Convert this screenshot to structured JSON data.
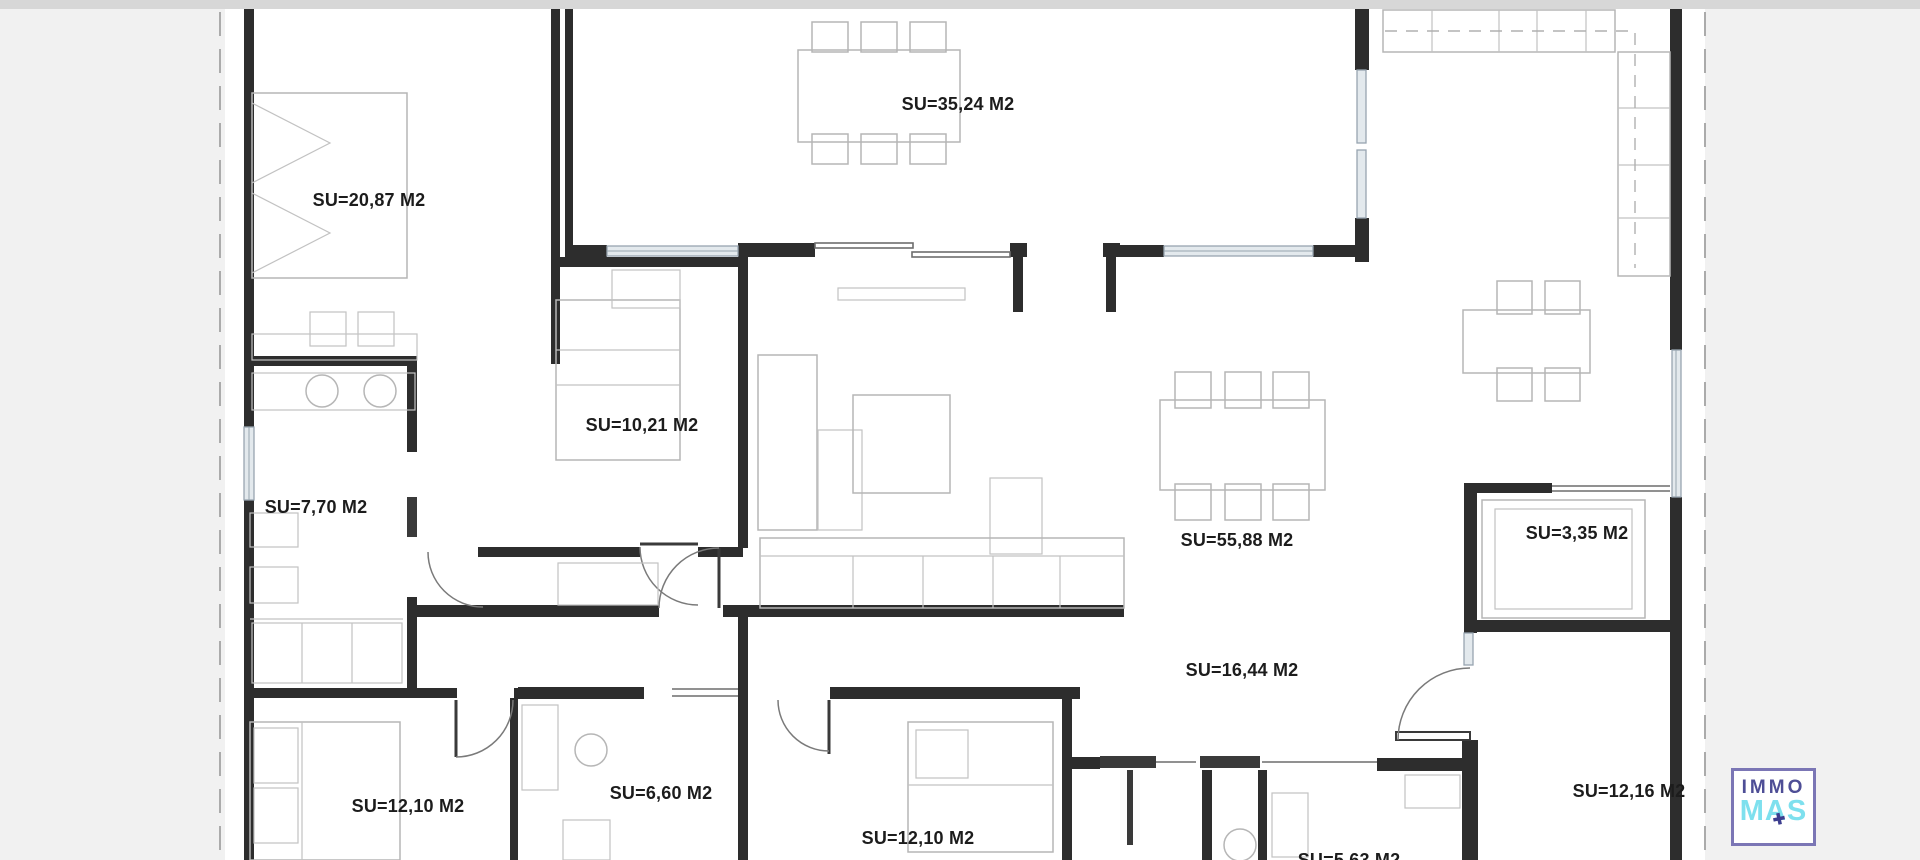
{
  "page": {
    "background": "#f1f1f1",
    "plan_background": "#ffffff",
    "top_strip_color": "#d7d7d7"
  },
  "colors": {
    "wall": "#2d2d2d",
    "furniture_line": "#b6b6b6",
    "window_fill": "#e3e9ed",
    "window_line": "#97a5b0",
    "boundary_dash": "#ababab",
    "door_arc": "#7a7a7a",
    "label_text": "#1c1c1c"
  },
  "floor_plan": {
    "type": "apartment-floor-plan",
    "unit_suffix": "M2",
    "rooms": [
      {
        "id": "bedroom-top-left",
        "label": "SU=20,87 M2",
        "area_m2": "20,87"
      },
      {
        "id": "dining-room-top",
        "label": "SU=35,24 M2",
        "area_m2": "35,24"
      },
      {
        "id": "bedroom-mid-left",
        "label": "SU=10,21 M2",
        "area_m2": "10,21"
      },
      {
        "id": "laundry-left",
        "label": "SU=7,70 M2",
        "area_m2": "7,70"
      },
      {
        "id": "living-room",
        "label": "SU=55,88 M2",
        "area_m2": "55,88"
      },
      {
        "id": "bathroom-right",
        "label": "SU=3,35 M2",
        "area_m2": "3,35"
      },
      {
        "id": "hallway",
        "label": "SU=16,44 M2",
        "area_m2": "16,44"
      },
      {
        "id": "bedroom-bottom-left",
        "label": "SU=12,10 M2",
        "area_m2": "12,10"
      },
      {
        "id": "bathroom-left",
        "label": "SU=6,60 M2",
        "area_m2": "6,60"
      },
      {
        "id": "bedroom-bottom-middle",
        "label": "SU=12,10 M2",
        "area_m2": "12,10"
      },
      {
        "id": "wc-bottom",
        "label": "SU=5,63 M2",
        "area_m2": "5,63"
      },
      {
        "id": "room-bottom-right",
        "label": "SU=12,16 M2",
        "area_m2": "12,16"
      }
    ]
  },
  "branding": {
    "logo_line1": "IMMO",
    "logo_line2": "MAS",
    "logo_accent_glyph": "✚",
    "logo_border_color": "#7b76b5",
    "logo_line1_color": "#4e4e96",
    "logo_line2_color": "#7ee0ee",
    "logo_accent_color": "#3d3e8f"
  }
}
